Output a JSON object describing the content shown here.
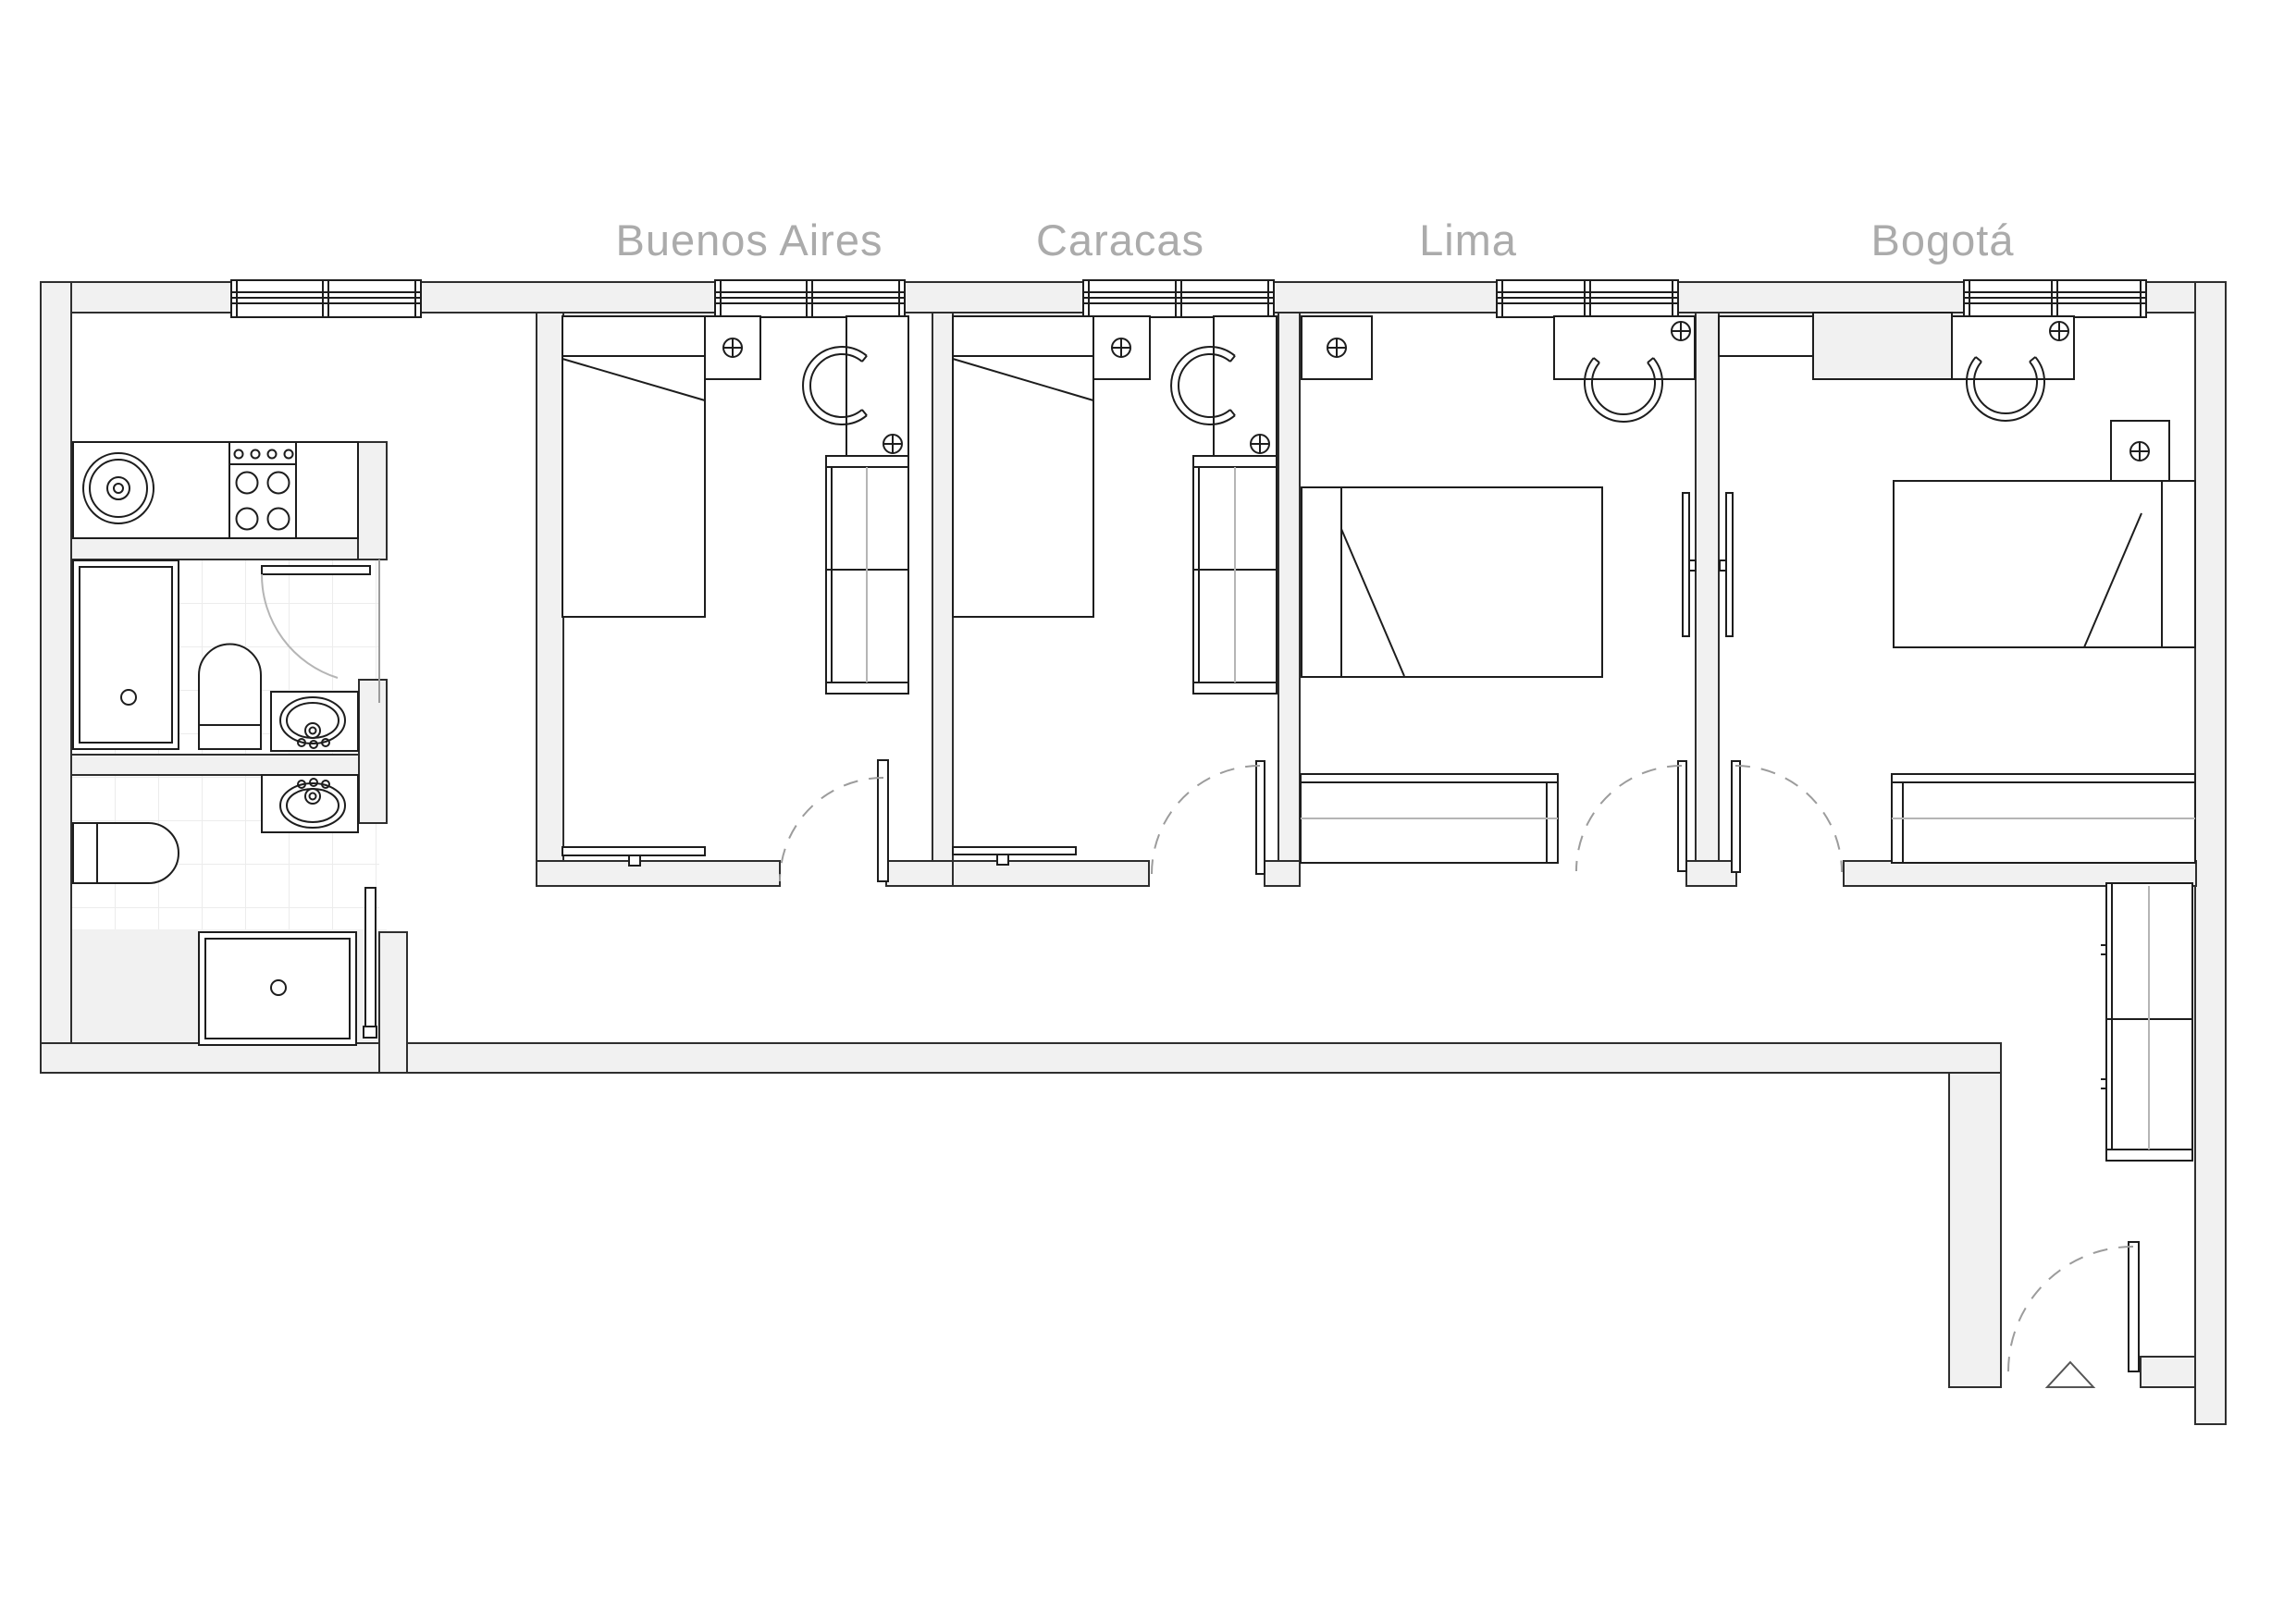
{
  "plan": {
    "title_visible": false,
    "rooms": [
      {
        "id": "buenos-aires",
        "label": "Buenos Aires"
      },
      {
        "id": "caracas",
        "label": "Caracas"
      },
      {
        "id": "lima",
        "label": "Lima"
      },
      {
        "id": "bogota",
        "label": "Bogotá"
      }
    ],
    "fixtures": {
      "kitchen": [
        "kitchen-sink",
        "stove-4-burners",
        "base-cabinet"
      ],
      "bathroom_top": [
        "shower-tray",
        "toilet",
        "washbasin",
        "hinged-door"
      ],
      "bathroom_bottom": [
        "toilet",
        "washbasin",
        "shower-tray",
        "sliding-door"
      ],
      "bedrooms_common": [
        "single-bed",
        "nightstand",
        "desk",
        "chair",
        "wardrobe",
        "radiator",
        "hinged-door",
        "window",
        "outlet-symbol"
      ],
      "lima_bogota": [
        "double-bed",
        "bench-sideboard",
        "wall-radiator"
      ],
      "hallway": [
        "tall-cabinet",
        "entry-door",
        "entry-triangle-marker"
      ]
    }
  },
  "colors": {
    "wall_fill": "#f1f1f1",
    "wall_line": "#2e2e2e",
    "fixture_line": "#1d1d1d",
    "label_text": "#ababab",
    "door_arc": "#9c9c9c",
    "tile_line": "#ececec",
    "soft_line": "#b5b5b5"
  }
}
